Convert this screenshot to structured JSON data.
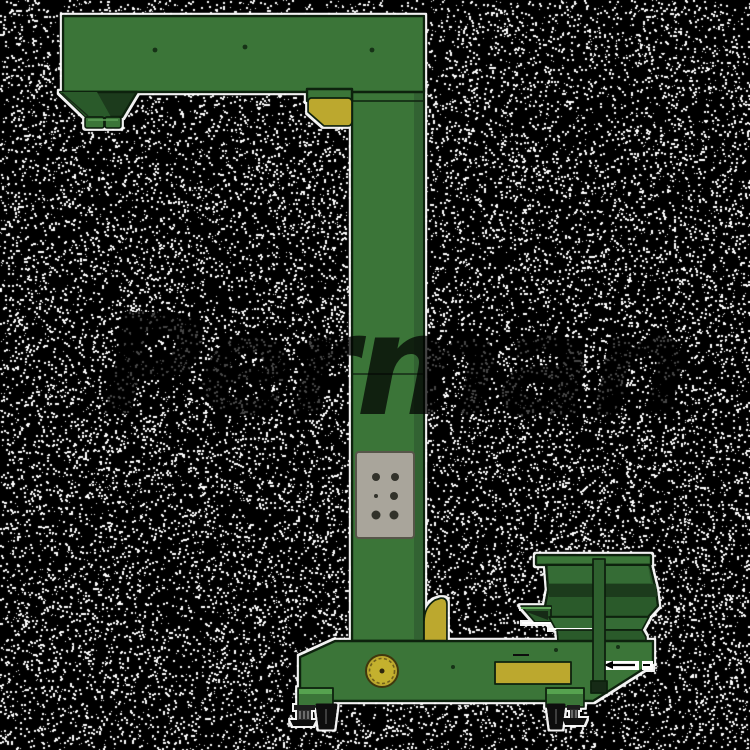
{
  "watermark": {
    "text": "Perman",
    "color": "#000000",
    "opacity": 0.72
  },
  "background": {
    "base_color": "#000000",
    "speckle_color": "#ffffff",
    "speckle_density": 0.16
  },
  "machine": {
    "colors": {
      "body_green": "#3a7439",
      "green_light": "#57a24f",
      "green_dark": "#2c5a2c",
      "green_darker": "#1b3a1b",
      "outline": "#0e200e",
      "accent_yellow": "#bca82e",
      "yellow_deep": "#6f611a",
      "panel_gray": "#a9a59b",
      "panel_border": "#56544a",
      "hole_dark": "#31312a",
      "halo_white": "#ffffff",
      "wheel_black": "#0c0c0c"
    }
  }
}
